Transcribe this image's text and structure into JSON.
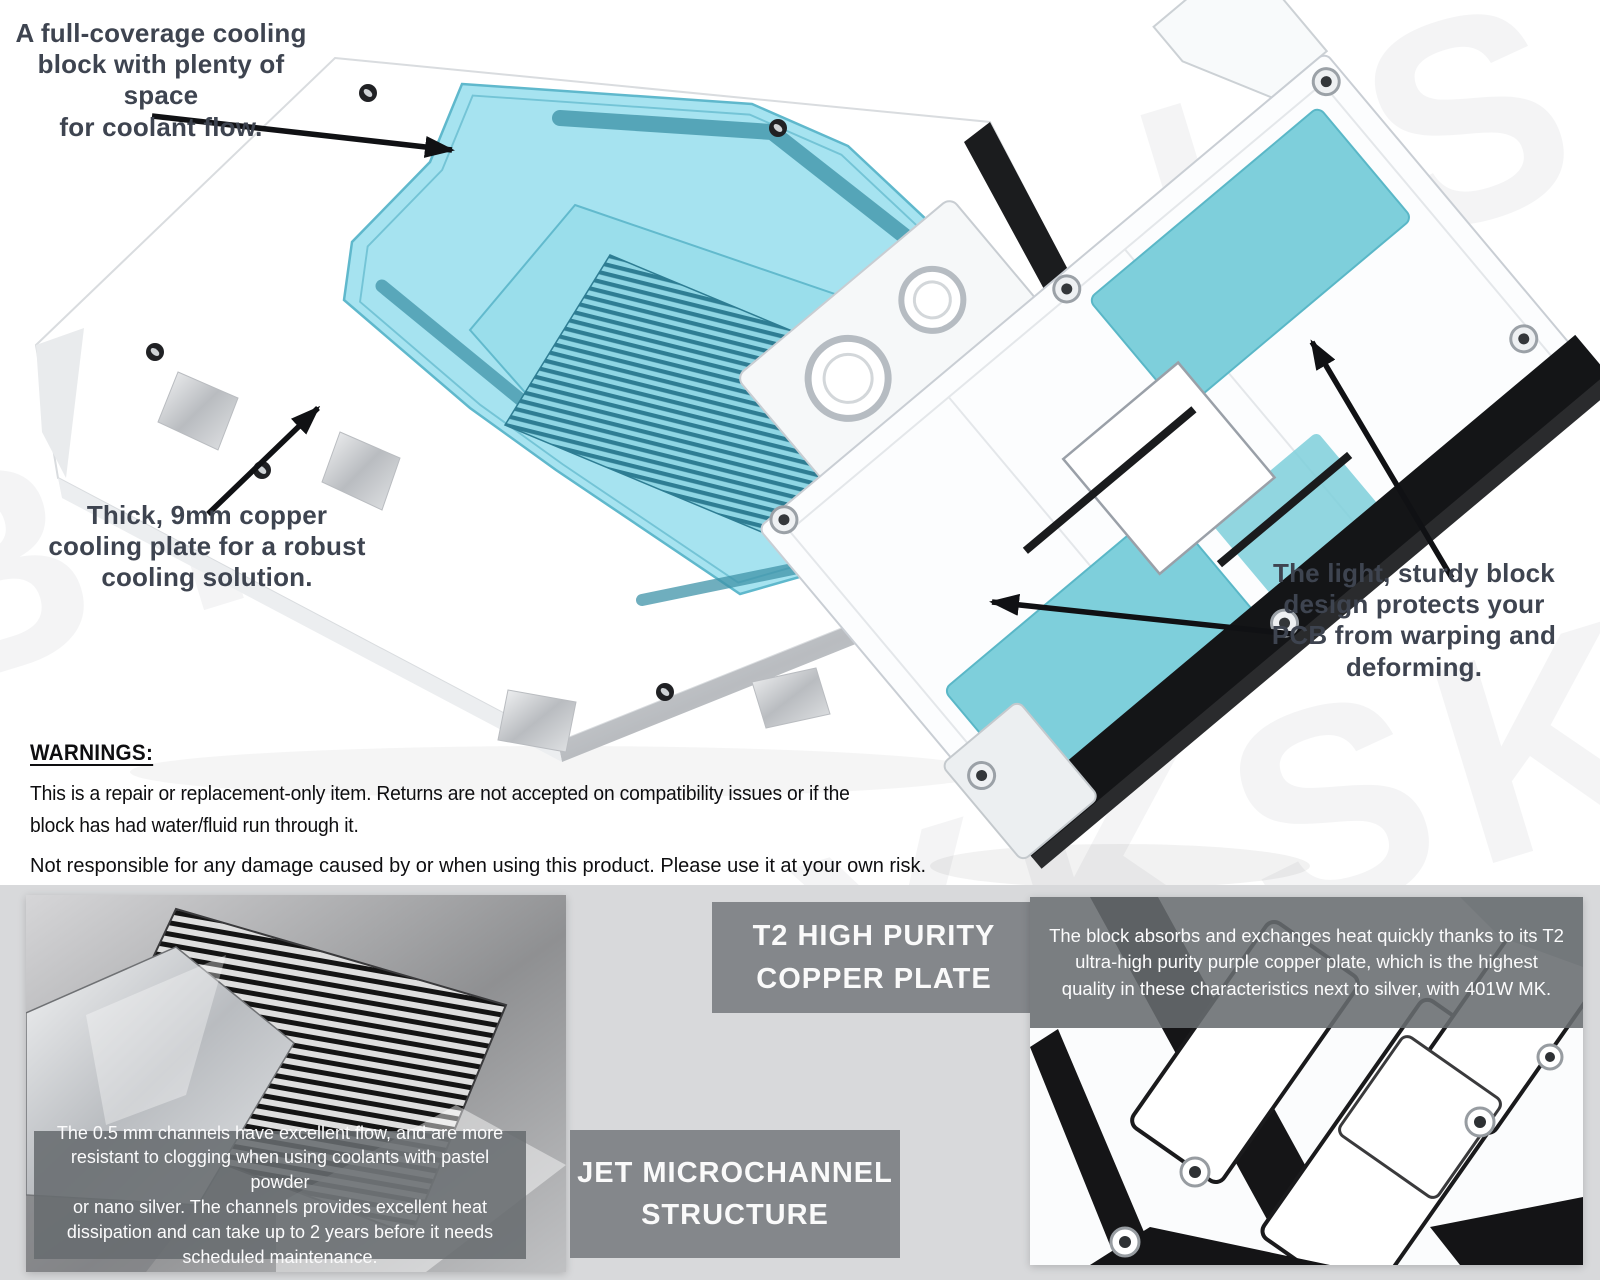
{
  "product": {
    "watermark": "BYKSKI.US",
    "annotations": {
      "coolant_flow": "A full-coverage cooling\nblock with plenty of space\nfor coolant flow.",
      "copper_plate": "Thick, 9mm copper\ncooling plate for a robust\ncooling solution.",
      "pcb_protection": "The light, sturdy block\ndesign protects your\nPCB from warping and\ndeforming."
    },
    "warnings": {
      "title": "WARNINGS:",
      "para1": "This is a repair or replacement-only item. Returns are not accepted on compatibility issues or if the\nblock has had water/fluid run through it.",
      "para2": "Not responsible for any damage caused by or when using this product. Please use it at your own risk."
    },
    "features": [
      {
        "title": "T2 HIGH PURITY\nCOPPER PLATE",
        "description": "The block absorbs and exchanges heat quickly thanks to its T2\nultra-high purity purple copper plate, which is the highest\nquality in these characteristics next to silver, with 401W MK."
      },
      {
        "title": "JET MICROCHANNEL\nSTRUCTURE",
        "description": "The 0.5 mm channels have excellent flow, and are more\nresistant to clogging when using coolants with pastel powder\nor nano silver. The channels provides excellent heat\ndissipation and can take up to 2 years before it needs\nscheduled maintenance."
      }
    ],
    "colors": {
      "accent_teal": "#A6E3F0",
      "teal_dark": "#3F93A8",
      "pad_teal": "#7ECFDB",
      "banner_gray": "#84878B",
      "overlay_gray": "rgba(104,108,112,0.88)",
      "annotation_text": "#3E4450",
      "strip_bg": "#D8D9DB"
    }
  }
}
